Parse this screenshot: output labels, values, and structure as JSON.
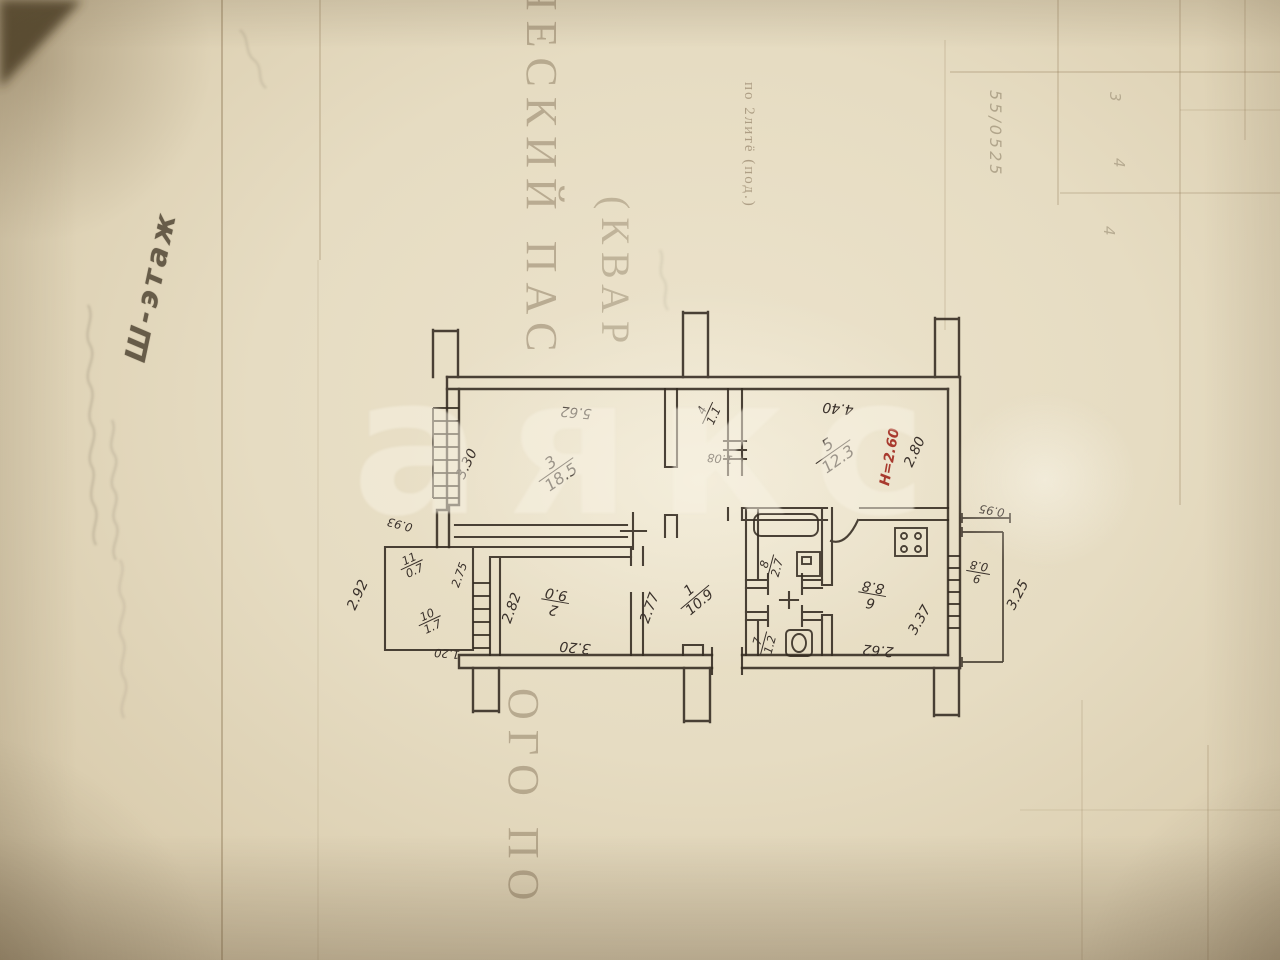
{
  "document": {
    "floor_note": "Ш-этаж",
    "heading_vertical_top": "ЧЕСКИЙ ПАС",
    "heading_vertical_kvar": "(КВАР",
    "heading_vertical_bottom": "ОГО ПО",
    "form_caption": "по 2литё (под.)",
    "ghost_numbers": {
      "col1": "55/0525",
      "n1": "3",
      "n2": "4",
      "n3": "4"
    },
    "watermark": "аякс"
  },
  "plan": {
    "height_mark": "H=2.60",
    "height_color": "#a83a2e",
    "ink_color": "#332a20",
    "rooms": [
      {
        "number": "3",
        "area": "18.5"
      },
      {
        "number": "4",
        "area": "1.1"
      },
      {
        "number": "5",
        "area": "12.3"
      },
      {
        "number": "11",
        "area": "0.7"
      },
      {
        "number": "10",
        "area": "1.7"
      },
      {
        "number": "2",
        "area": "9.0"
      },
      {
        "number": "1",
        "area": "10.9"
      },
      {
        "number": "8",
        "area": "2.7"
      },
      {
        "number": "7",
        "area": "1.2"
      },
      {
        "number": "6",
        "area": "8.8"
      },
      {
        "number": "9",
        "area": "0.8"
      }
    ],
    "dimensions": [
      "3.30",
      "5.62",
      "1.08",
      "4.40",
      "2.80",
      "0.93",
      "2.75",
      "1.20",
      "2.92",
      "2.82",
      "3.20",
      "2.77",
      "2.62",
      "3.37",
      "0.95",
      "3.25"
    ]
  }
}
